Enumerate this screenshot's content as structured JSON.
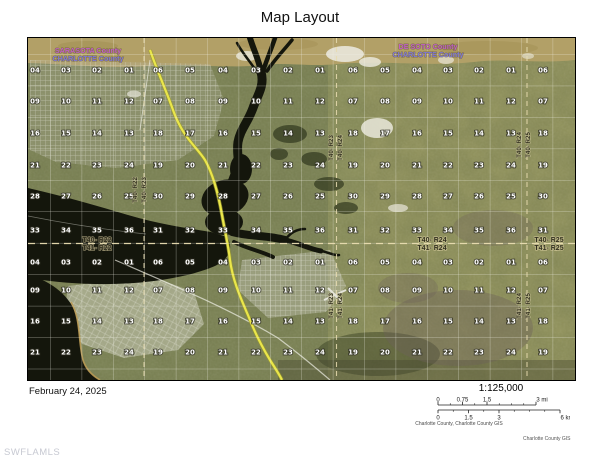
{
  "title": "Map Layout",
  "date": "February 24, 2025",
  "watermark": "SWFLAMLS",
  "credit": "Charlotte County GIS",
  "scalebar": {
    "ratio": "1:125,000",
    "attribution": "Charlotte County, Charlotte County GIS",
    "miles": {
      "max": 3,
      "labels": [
        {
          "text": "0",
          "v": 0
        },
        {
          "text": "0.75",
          "v": 0.75
        },
        {
          "text": "1.5",
          "v": 1.5
        },
        {
          "text": "3 mi",
          "v": 3
        }
      ]
    },
    "km": {
      "max": 6,
      "labels": [
        {
          "text": "0",
          "v": 0
        },
        {
          "text": "1.5",
          "v": 1.5
        },
        {
          "text": "3",
          "v": 3
        },
        {
          "text": "6 km",
          "v": 6
        }
      ]
    }
  },
  "map": {
    "colors": {
      "county_top": "#c05fc5",
      "county_bottom": "#7f78d6",
      "highway": "#eae64b",
      "water": "#14160c",
      "land": "#7d8457",
      "farm_band": "#b2a067",
      "grid_line": "#f2f2e8",
      "dash_line": "#e8dcb0",
      "section_text": "#ffffff",
      "township_text": "#32301f"
    },
    "counties": [
      {
        "top": "SARASOTA County",
        "bottom": "CHARLOTTE County",
        "x": 88,
        "y": 53
      },
      {
        "top": "DE SOTO County",
        "bottom": "CHARLOTTE County",
        "x": 428,
        "y": 49
      }
    ],
    "township_labels": [
      {
        "top": "T40- R22",
        "bottom": "T41- R22",
        "x": 97,
        "y": 243
      },
      {
        "top": "T40- R24",
        "bottom": "T41- R24",
        "x": 432,
        "y": 243
      },
      {
        "top": "T40- R25",
        "bottom": "T41- R25",
        "x": 549,
        "y": 243
      }
    ],
    "range_labels": [
      {
        "left": "T40- R22",
        "right": "T40- R23",
        "x": 141,
        "y": 190
      },
      {
        "left": "T40- R23",
        "right": "T40- R24",
        "x": 337,
        "y": 148
      },
      {
        "left": "T41- R23",
        "right": "T41- R24",
        "x": 337,
        "y": 306
      },
      {
        "left": "T40- R24",
        "right": "T40- R25",
        "x": 525,
        "y": 145
      },
      {
        "left": "T41- R24",
        "right": "T41- R25",
        "x": 525,
        "y": 306
      }
    ],
    "sections": {
      "t40_row_y": [
        70,
        101,
        133,
        165,
        196,
        230
      ],
      "t41_row_y": [
        262,
        290,
        321,
        352
      ],
      "t40_rows": [
        [
          "06",
          "05",
          "04",
          "03",
          "02",
          "01"
        ],
        [
          "07",
          "08",
          "09",
          "10",
          "11",
          "12"
        ],
        [
          "18",
          "17",
          "16",
          "15",
          "14",
          "13"
        ],
        [
          "19",
          "20",
          "21",
          "22",
          "23",
          "24"
        ],
        [
          "30",
          "29",
          "28",
          "27",
          "26",
          "25"
        ],
        [
          "31",
          "32",
          "33",
          "34",
          "35",
          "36"
        ]
      ],
      "t41_rows": [
        [
          "06",
          "05",
          "04",
          "03",
          "02",
          "01"
        ],
        [
          "07",
          "08",
          "09",
          "10",
          "11",
          "12"
        ],
        [
          "18",
          "17",
          "16",
          "15",
          "14",
          "13"
        ],
        [
          "19",
          "20",
          "21",
          "22",
          "23",
          "24"
        ]
      ],
      "ranges": [
        {
          "cols": [
            35,
            66,
            97,
            129
          ],
          "first_col_index": 2
        },
        {
          "cols": [
            158,
            190,
            223,
            256,
            288,
            320
          ],
          "first_col_index": 0
        },
        {
          "cols": [
            353,
            385,
            417,
            448,
            479,
            511
          ],
          "first_col_index": 0
        },
        {
          "cols": [
            543
          ],
          "first_col_index": 0
        }
      ]
    }
  }
}
